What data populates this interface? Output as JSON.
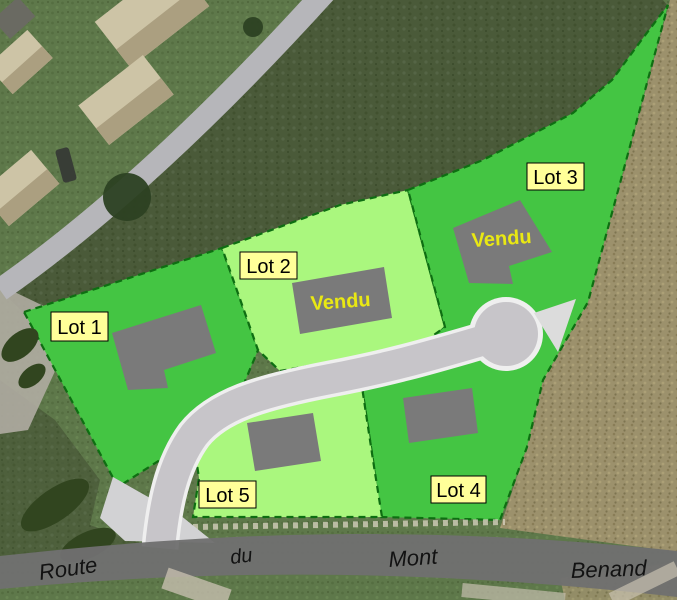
{
  "map": {
    "kind": "subdivision-site-plan-over-aerial-photo",
    "colors": {
      "lot_bright_green": "#44c543",
      "lot_pale_green": "#aaf77e",
      "lot_boundary_dash": "#0e6e12",
      "building_gray": "#7a7a7a",
      "label_background": "#ffff99",
      "label_text": "#000000",
      "sold_text_yellow": "#e9e813",
      "access_road_gray": "#c7c5c9",
      "access_road_casing": "#efefef",
      "main_road_gray": "#6f6f6f"
    },
    "lots": [
      {
        "id": "lot-1",
        "label": "Lot 1",
        "sold": false
      },
      {
        "id": "lot-2",
        "label": "Lot 2",
        "sold": true,
        "sold_label": "Vendu"
      },
      {
        "id": "lot-3",
        "label": "Lot 3",
        "sold": true,
        "sold_label": "Vendu"
      },
      {
        "id": "lot-4",
        "label": "Lot 4",
        "sold": false
      },
      {
        "id": "lot-5",
        "label": "Lot 5",
        "sold": false
      }
    ],
    "road_name": {
      "full": "Route du Mont Benand",
      "words": [
        "Route",
        "du",
        "Mont",
        "Benand"
      ]
    }
  }
}
